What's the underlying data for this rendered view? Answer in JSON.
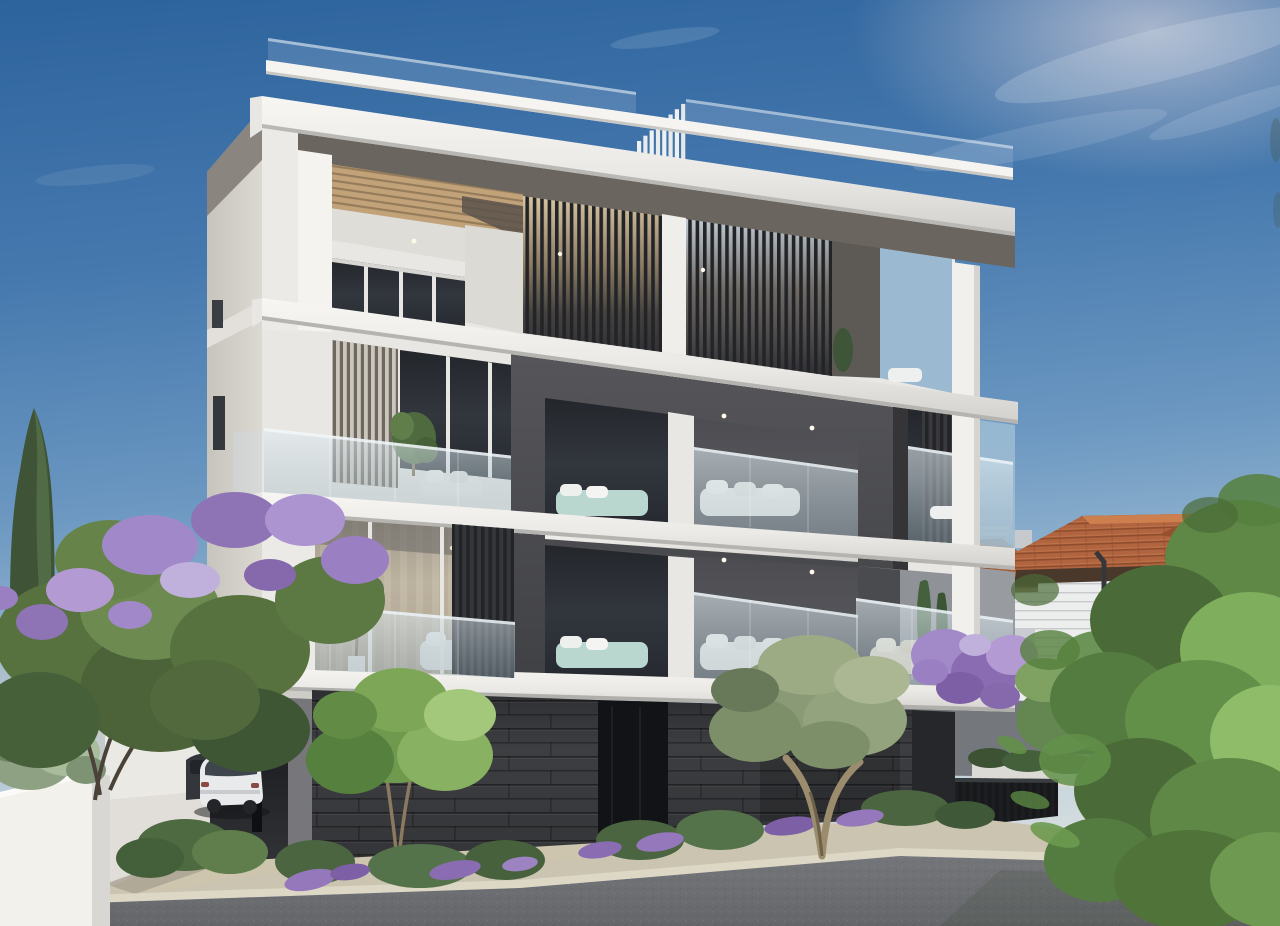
{
  "meta": {
    "type": "architectural-exterior-render",
    "subject": "Modern four-level apartment building at dusk with street, parked cars, neighbouring villa and mediterranean planting",
    "time_of_day": "late afternoon / dusk",
    "weather": "clear sky with thin high clouds"
  },
  "palette": {
    "sky_top": "#2d639d",
    "sky_upper": "#4679ae",
    "sky_mid": "#6b97c1",
    "sky_low": "#a6c2d6",
    "sky_horizon": "#d8dfe0",
    "horizon_warm": "#e4d2bf",
    "cloud": "#e9eff5",
    "concrete": "#f2f1ed",
    "concrete_shade": "#dddbd6",
    "concrete_dark": "#bfbeba",
    "soffit": "#6b655f",
    "pergola_wood": "#c2a279",
    "dark_box": "#4b4c50",
    "dark_box_deep": "#39393d",
    "window_glass": "#2c2f34",
    "glass_rail": "#c6d5dd",
    "louver_dark": "#232428",
    "louver_light": "#cbc6bb",
    "stone": "#3a3b3e",
    "stone_deep": "#26272a",
    "entrance_recess": "#121316",
    "road": "#74767a",
    "road_deep": "#64666a",
    "sidewalk": "#cbc4b0",
    "curb": "#ddd7c5",
    "driveway": "#c6bfa9",
    "soil": "#6e6557",
    "wall_white": "#eceae5",
    "planter_white": "#f4f3ef",
    "house_wall": "#e9eaec",
    "house_roof": "#b06540",
    "house_roof_dark": "#8a4a28",
    "house_fascia": "#4a382b",
    "green_dark": "#3c5233",
    "green_mid": "#5d7c47",
    "green_bright": "#7fae5c",
    "green_light": "#9cc873",
    "olive_green": "#8b9a76",
    "olive_light": "#aab792",
    "gray_green": "#93a585",
    "purple_bloom": "#a189c9",
    "purple_deep": "#7e5fa5",
    "purple_light": "#c0b0dc",
    "trunk": "#9b8c6d",
    "branch": "#4a4238",
    "car_body": "#e9eaec",
    "car_glass": "#3f454d",
    "teal_accent": "#b9d6cf",
    "warm_interior": "#c9b898"
  },
  "scene": {
    "building": {
      "storeys": 4,
      "style": "contemporary white concrete frame with charcoal recessed core",
      "features": [
        "roof terrace with glass balustrade and ascending metal fins",
        "timber pergola ceiling on penthouse level",
        "vertical louver screens in dark and light tones",
        "frameless glass balcony balustrades",
        "recessed charcoal balcony box with white sofas and downlights",
        "teal bedding visible through bedroom glazing",
        "dark stone clad base with recessed entrance",
        "open carport on pilotis"
      ]
    },
    "vehicles": [
      {
        "kind": "white estate car",
        "location": "carport driveway left"
      },
      {
        "kind": "dark car, partly hidden",
        "location": "behind white car"
      }
    ],
    "vegetation": [
      "tall cypress at left",
      "jacaranda tree with purple blossom at left",
      "rosemary spilling from white planter bottom left",
      "bright green young tree at centre",
      "silver-leaved olive tree right of centre",
      "lavender-like purple shrubs along the base planting strip",
      "clipped hedge above neighbour garden wall",
      "large sunlit foreground tree at right"
    ],
    "neighborhood": [
      "two-storey villa with terracotta hip roof and white horizontal siding",
      "distant light high-rise blocks on the horizon",
      "white boundary walls",
      "dark vertical-slat garden fence"
    ],
    "street": {
      "elements": [
        "asphalt road",
        "light stone curb",
        "beige concrete sidewalk and driveway apron"
      ]
    }
  }
}
